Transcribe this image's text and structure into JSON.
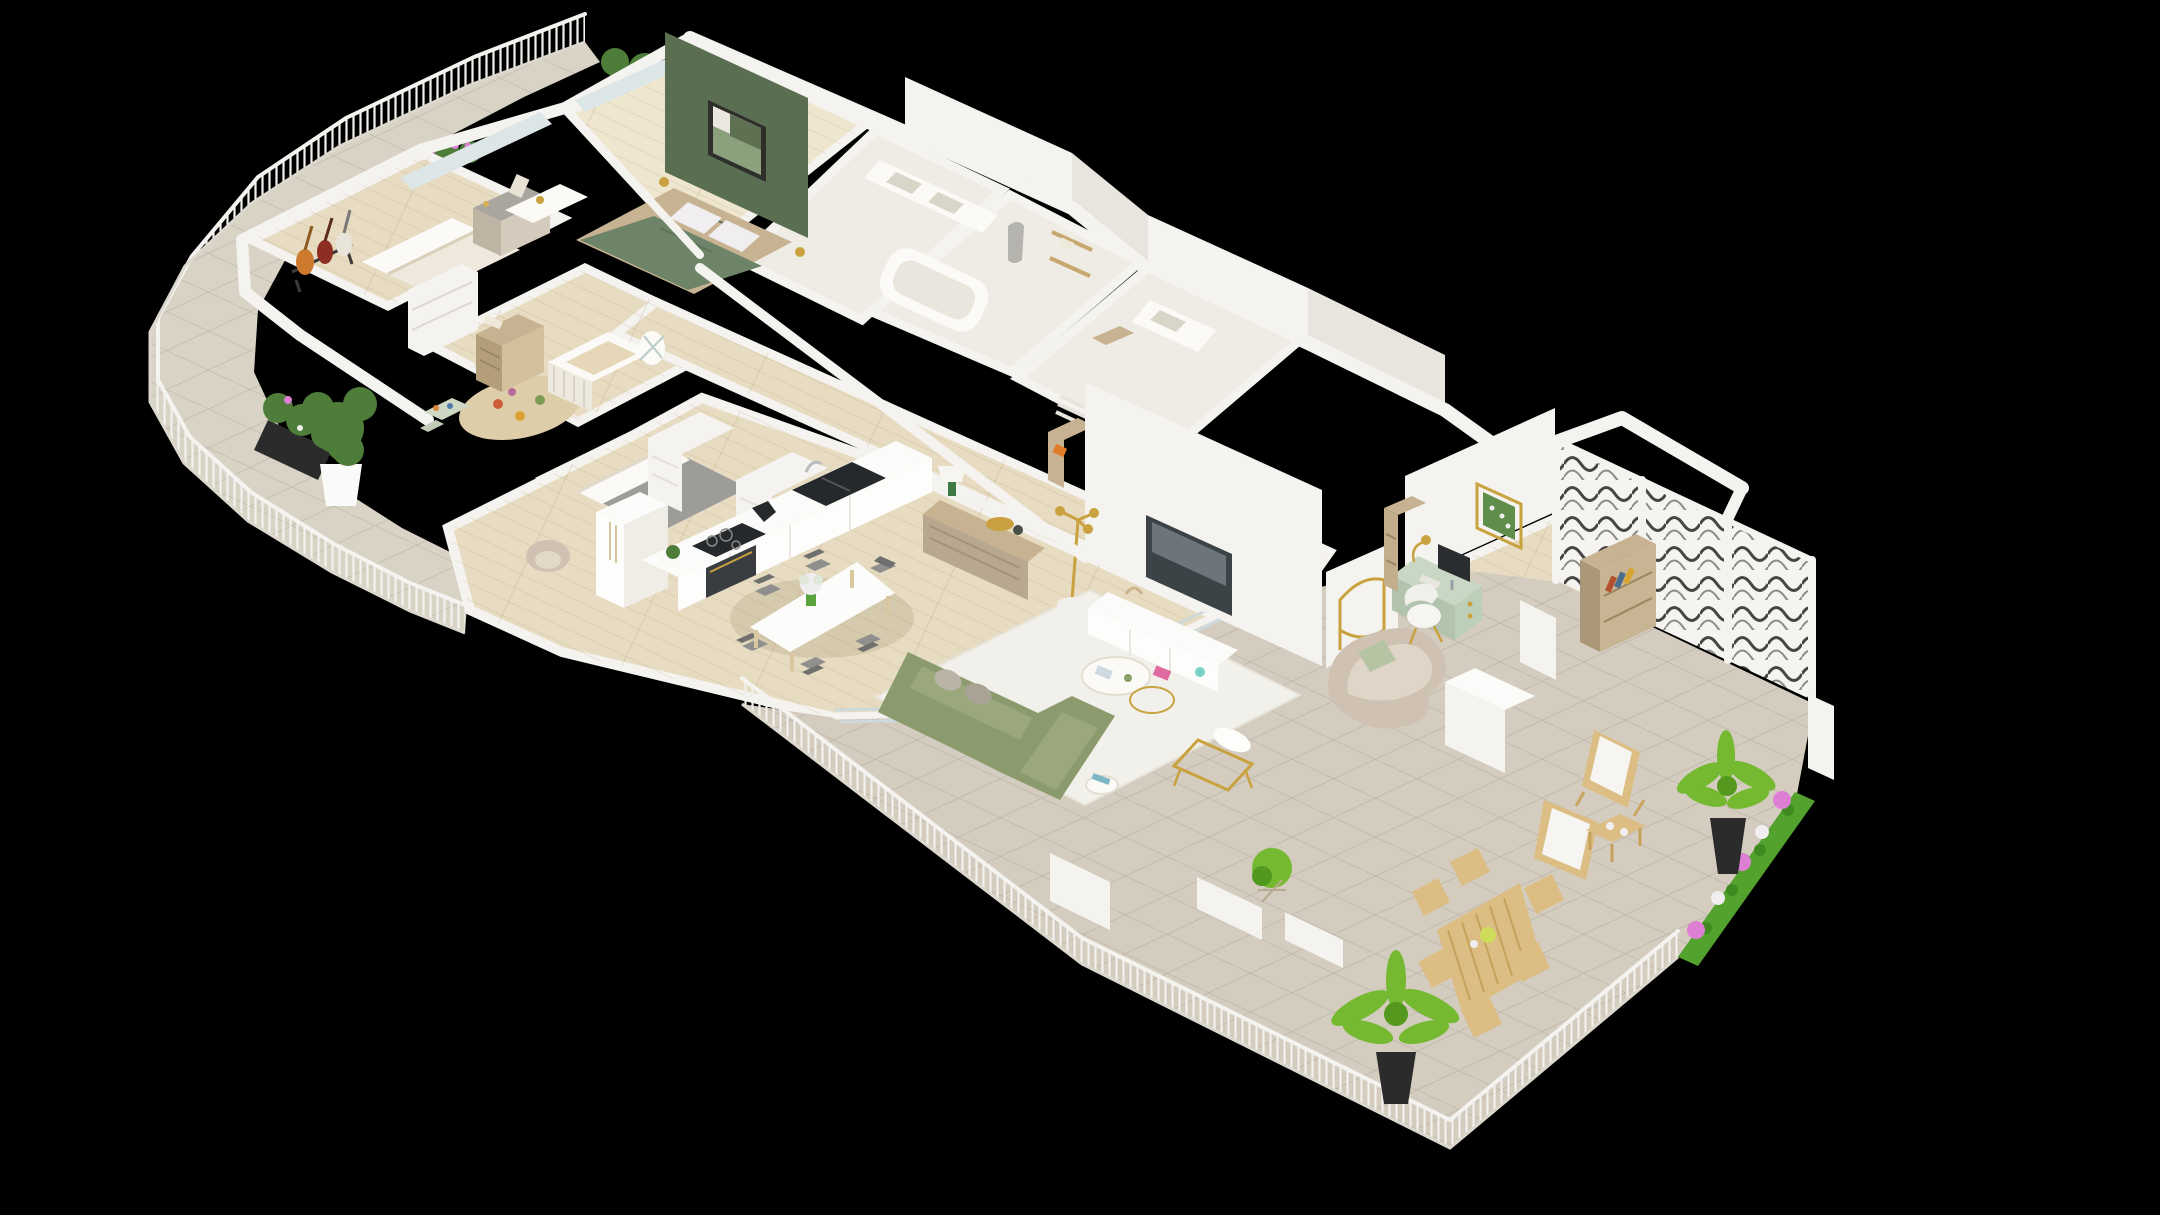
{
  "scene": {
    "title": "3D apartment floor plan",
    "view": "isometric cutaway render",
    "description": "Isometric 3D cutaway floor plan of a large apartment on a black background, with a curved planted balcony on the left, three bedrooms and a nursery, two bathrooms, an open kitchen, dining and living area, a home office nook, and a large tiled terrace with lattice privacy screen, palms and outdoor furniture on the right."
  },
  "colors": {
    "background": "#000000",
    "wall_white": "#f4f3ef",
    "wall_shade": "#e7e5de",
    "wall_top": "#fbfbf9",
    "floor_wood": "#e7dcc2",
    "floor_wood_light": "#efe6d0",
    "floor_bath": "#efece5",
    "tile_balcony": "#d9d3c6",
    "tile_terrace": "#d3ccbf",
    "accent_wall_green": "#5a6e51",
    "bed_green": "#6e8468",
    "sofa_green": "#8c9b6d",
    "sofa_beige": "#cfc2b2",
    "desk_mint": "#c9d8c5",
    "rug_white": "#f2f0ea",
    "appliance_dark": "#26292c",
    "gold": "#c9a23f",
    "wood_furniture": "#c7b291",
    "wood_sideboard": "#b7a88f",
    "wood_outdoor": "#dcbe85",
    "palm_green": "#74b92f",
    "hedge_green": "#53a22d",
    "plant_green": "#4e7d3a",
    "flower_pink": "#dd7fd3",
    "flower_white": "#f0eef0",
    "planter_concrete": "#a8a69e",
    "planter_black": "#2b2b2b",
    "chair_yellow": "#e8b63e",
    "chair_gray": "#8f8f8d",
    "glass_blue": "#dde6e6"
  },
  "rooms": [
    {
      "id": "balcony",
      "name": "Curved balcony garden",
      "items": [
        "white slatted railing",
        "tiled floor",
        "concrete flower planter",
        "black flower trough",
        "fiddle-leaf fig in white pot",
        "second fiddle-leaf fig"
      ]
    },
    {
      "id": "bedroom-music",
      "name": "Bedroom with guitar corner",
      "items": [
        "guitar stand with three guitars",
        "double bed",
        "dresser with mirror",
        "open shelf unit",
        "window planter with pink flowers"
      ]
    },
    {
      "id": "nursery",
      "name": "Nursery",
      "items": [
        "white crib",
        "wooden dresser",
        "play rug with toys",
        "kids table and chairs",
        "baby bouncer"
      ]
    },
    {
      "id": "bedroom-guest",
      "name": "Guest bedroom",
      "items": [
        "bed with gray blanket",
        "beige armchair"
      ]
    },
    {
      "id": "master-bedroom",
      "name": "Master bedroom",
      "items": [
        "green accent wall",
        "framed abstract art",
        "double bed with green duvet",
        "white pillows",
        "gold bedside lamps",
        "white vanity desk",
        "fiddle-leaf fig outside window"
      ]
    },
    {
      "id": "ensuite",
      "name": "En-suite bathroom",
      "items": [
        "double sink vanity"
      ]
    },
    {
      "id": "bathroom",
      "name": "Family bathroom",
      "items": [
        "bathtub",
        "hanging bathrobe",
        "wooden wall shelves",
        "towels"
      ]
    },
    {
      "id": "laundry",
      "name": "Laundry and WC",
      "items": [
        "washbasin",
        "towel radiator",
        "storage shelf"
      ]
    },
    {
      "id": "hallway",
      "name": "Hallway",
      "items": [
        "white wardrobe units",
        "entry shelf with orange box",
        "arched gold mirror",
        "beige pouf chair"
      ]
    },
    {
      "id": "kitchen",
      "name": "Kitchen",
      "items": [
        "long white island",
        "black double sink with faucet",
        "induction hob",
        "built-in oven",
        "coffee machine",
        "double-door fridge",
        "herb pot"
      ]
    },
    {
      "id": "dining",
      "name": "Dining area",
      "items": [
        "white dining table",
        "six yellow chairs with gray seats",
        "green vase with white bouquet"
      ]
    },
    {
      "id": "living-room",
      "name": "Living room",
      "items": [
        "olive green L-shaped sofa",
        "gray cushions",
        "white area rug",
        "round nesting coffee tables",
        "gold side table",
        "white and gold armchair",
        "side table with books",
        "wall-mounted TV",
        "white TV lowboard",
        "magazine",
        "wooden sideboard",
        "table lamp",
        "gold tray and vase",
        "gold floor lamp",
        "curved beige loveseat with green pillow",
        "plant in wire stand"
      ]
    },
    {
      "id": "home-office",
      "name": "Home office nook",
      "items": [
        "mint green desk",
        "monitor and keyboard",
        "gold desk lamp",
        "white chair",
        "framed botanical art",
        "wooden bookcase with books",
        "small cubby shelf"
      ]
    },
    {
      "id": "terrace",
      "name": "South terrace",
      "items": [
        "breeze-block lattice screen",
        "white railing",
        "two wooden deck chairs with white canvas",
        "small wooden coffee table with cups",
        "palm in black planter",
        "second palm in black planter",
        "flower-bed hedge with pink and white blooms",
        "wooden outdoor dining table",
        "six folding chairs",
        "white planter boxes",
        "sliding glass doors"
      ]
    }
  ]
}
